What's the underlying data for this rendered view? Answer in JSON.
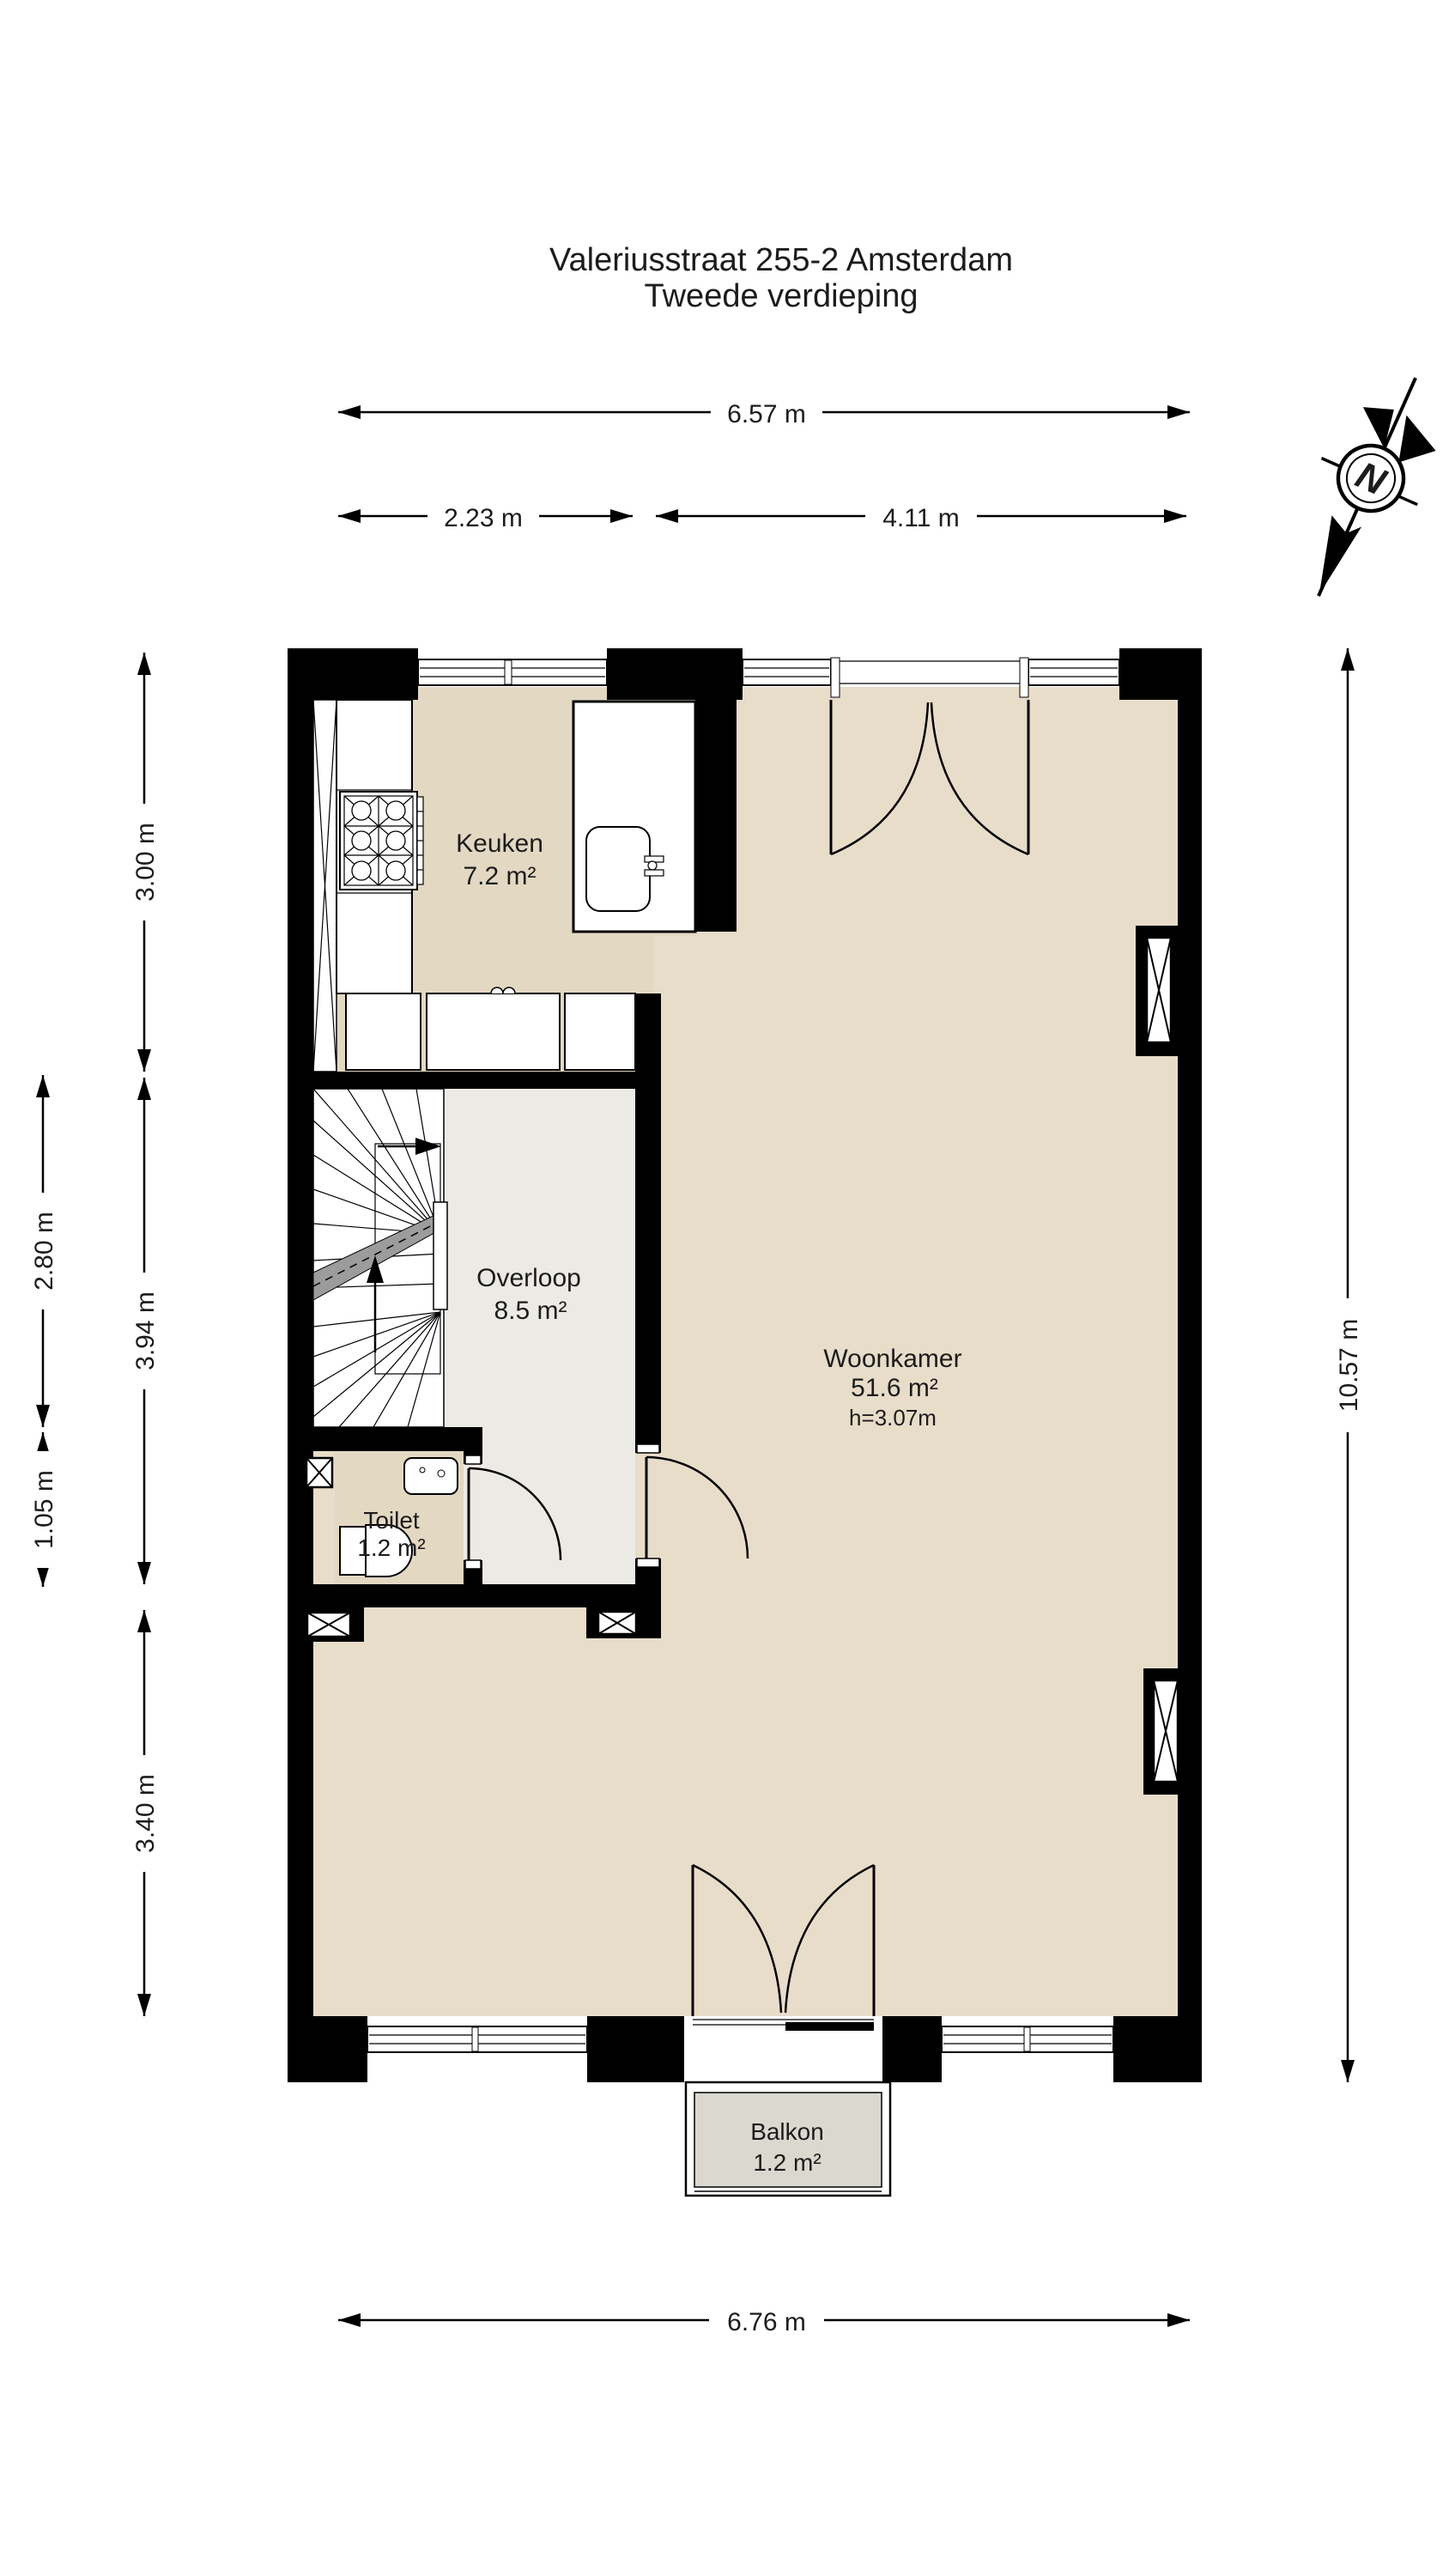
{
  "title": {
    "line1": "Valeriusstraat 255-2 Amsterdam",
    "line2": "Tweede verdieping"
  },
  "compass": {
    "north_label": "N"
  },
  "rooms": {
    "keuken": {
      "name": "Keuken",
      "area": "7.2 m²"
    },
    "overloop": {
      "name": "Overloop",
      "area": "8.5 m²"
    },
    "woonkamer": {
      "name": "Woonkamer",
      "area": "51.6 m²",
      "ceiling_height": "h=3.07m"
    },
    "toilet": {
      "name": "Toilet",
      "area": "1.2 m²"
    },
    "balkon": {
      "name": "Balkon",
      "area": "1.2 m²"
    }
  },
  "dimensions": {
    "top_total": "6.57 m",
    "top_left_segment": "2.23 m",
    "top_right_segment": "4.11 m",
    "left_kitchen": "3.00 m",
    "left_overloop": "3.94 m",
    "left_bottom": "3.40 m",
    "outer_stairs": "2.80 m",
    "outer_toilet": "1.05 m",
    "right_total": "10.57 m",
    "bottom_total": "6.76 m"
  },
  "colors": {
    "wall": "#000000",
    "floor_main": "#e7ddc9",
    "floor_kitchen": "#e3d8c2",
    "floor_overloop": "#eceae4",
    "floor_balcony": "#dbd8d0",
    "stair_band": "#9c9c9c"
  }
}
